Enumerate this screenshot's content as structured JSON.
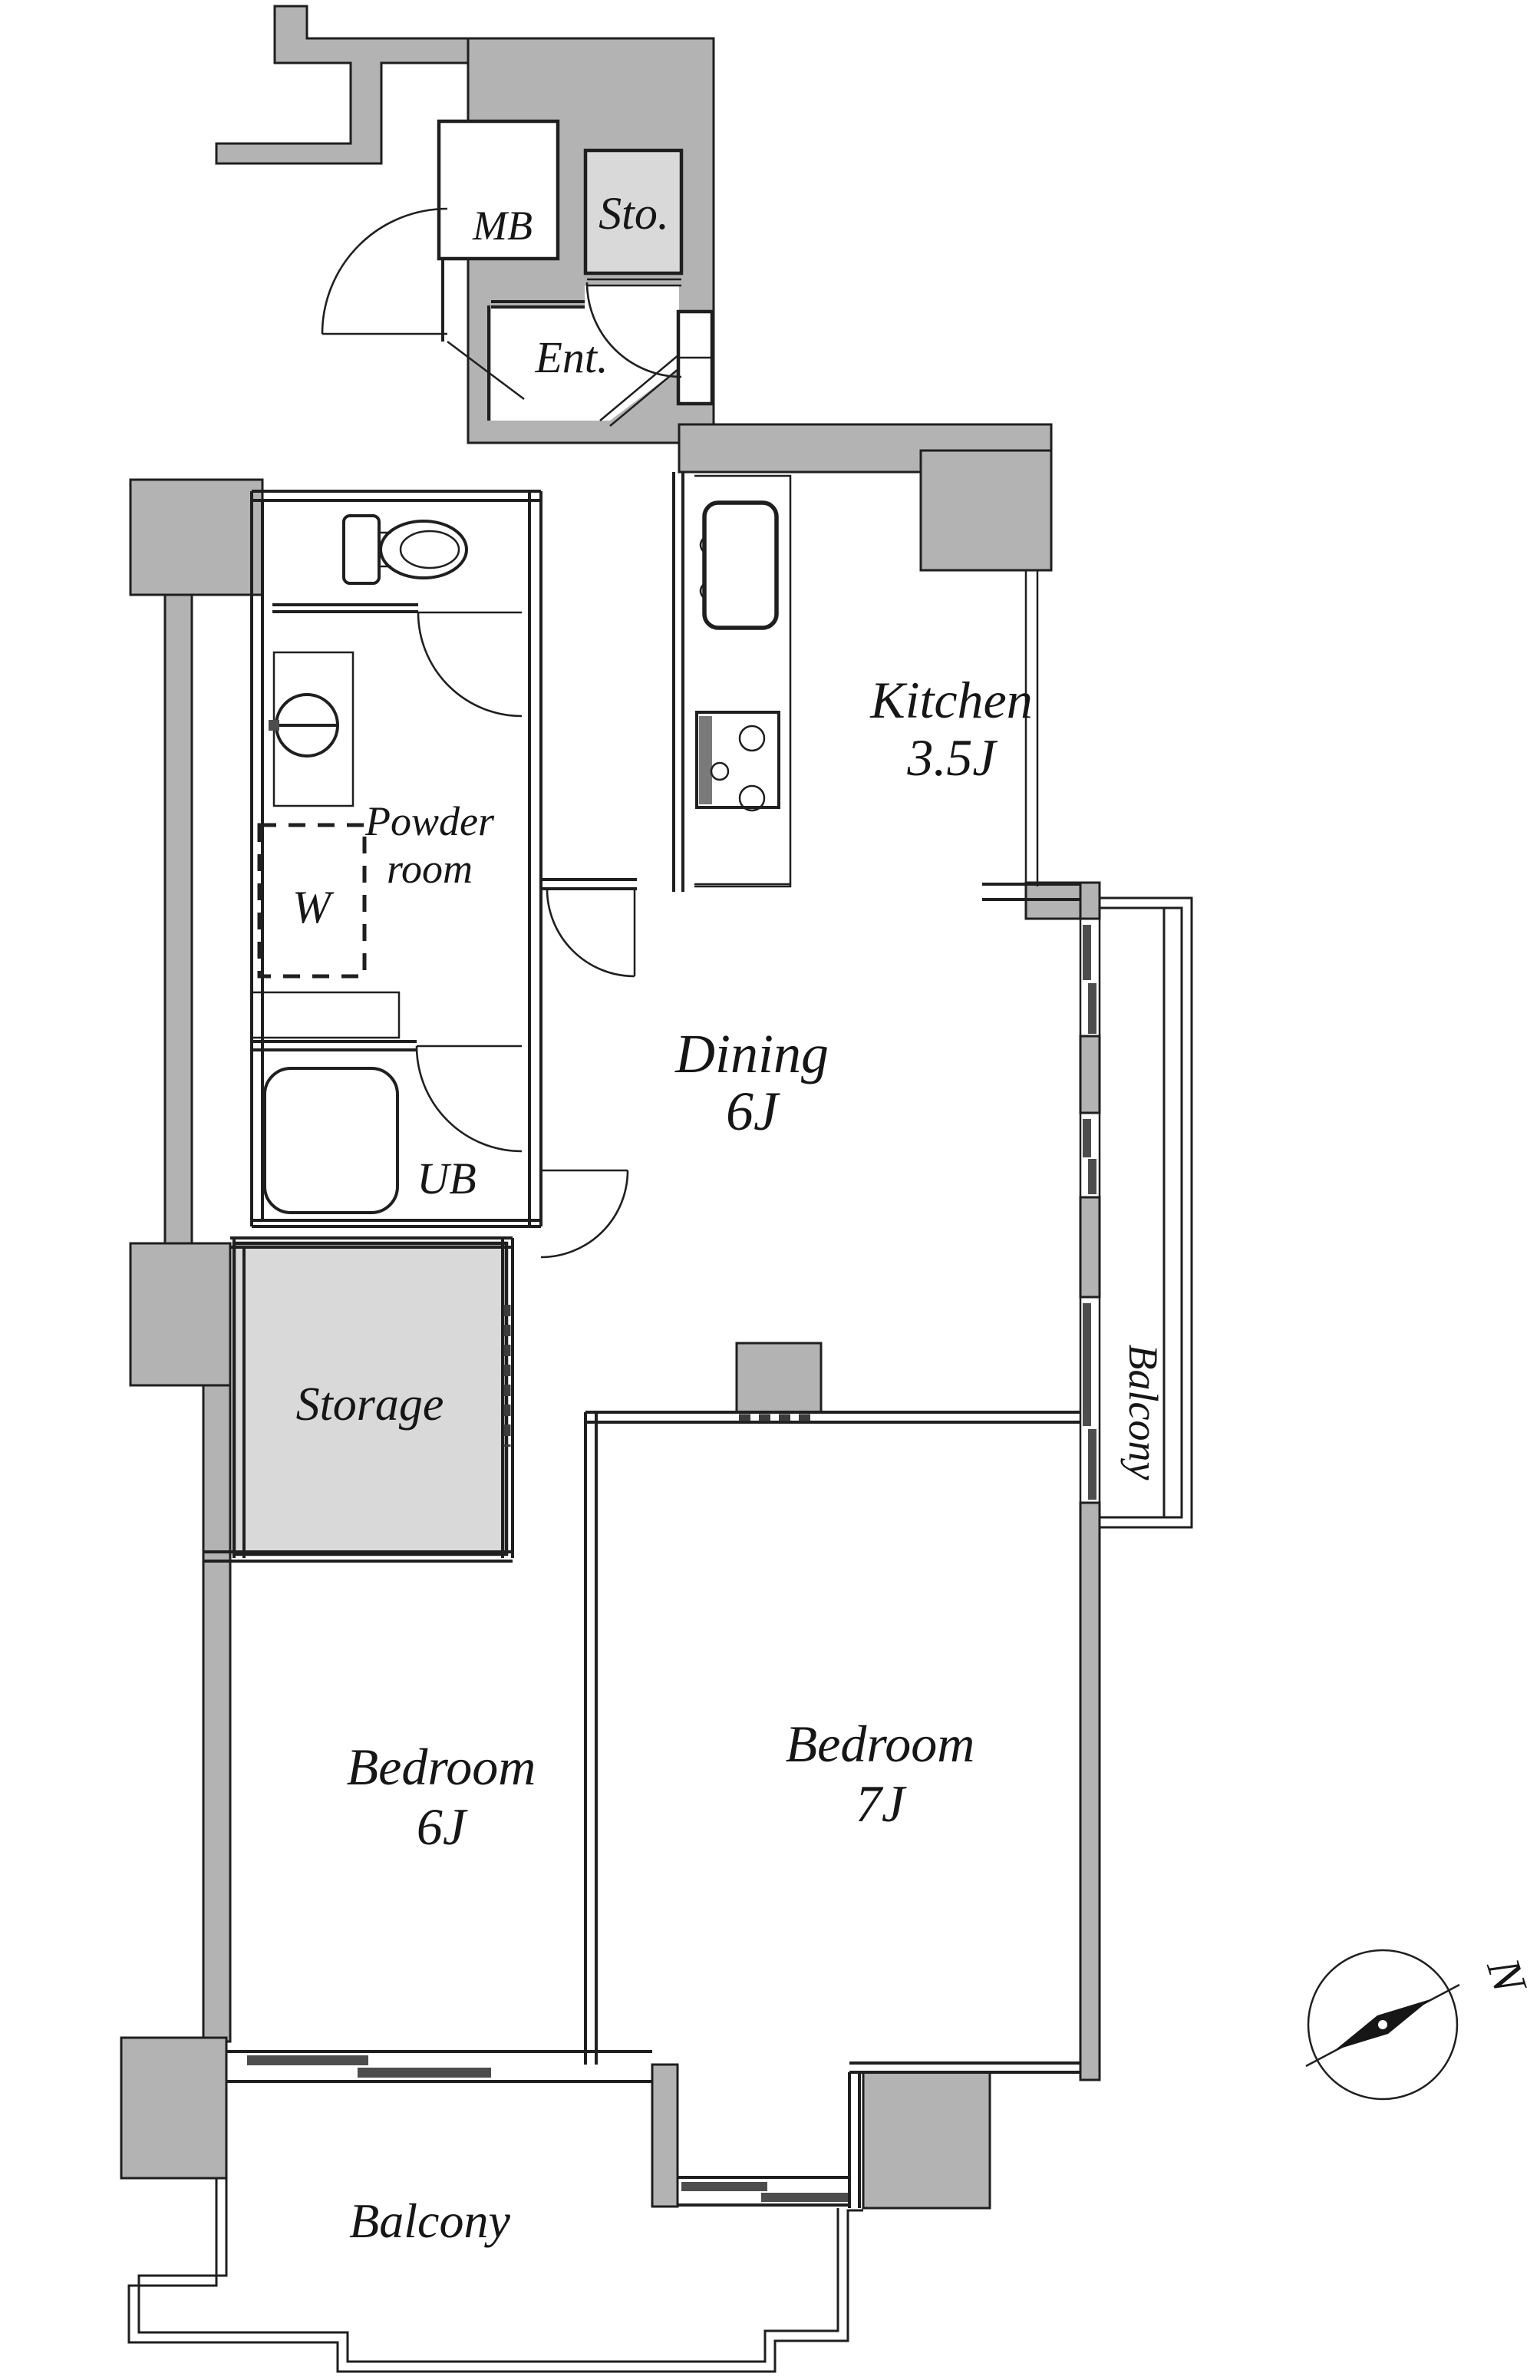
{
  "floorplan": {
    "type": "apartment-floor-plan",
    "rooms": {
      "mb": "MB",
      "sto": "Sto.",
      "ent": "Ent.",
      "kitchen": "Kitchen",
      "kitchen_size": "3.5J",
      "powder_line1": "Powder",
      "powder_line2": "room",
      "washer": "W",
      "ub": "UB",
      "dining": "Dining",
      "dining_size": "6J",
      "storage": "Storage",
      "bedroom6": "Bedroom",
      "bedroom6_size": "6J",
      "bedroom7": "Bedroom",
      "bedroom7_size": "7J",
      "balcony_right": "Balcony",
      "balcony_bottom": "Balcony"
    },
    "compass": {
      "north_label": "N"
    },
    "colors": {
      "wall": "#b3b3b3",
      "shaded_room": "#d9d9d9",
      "line": "#1f1f1f",
      "window_bar": "#4d4d4d",
      "background": "#ffffff"
    }
  }
}
